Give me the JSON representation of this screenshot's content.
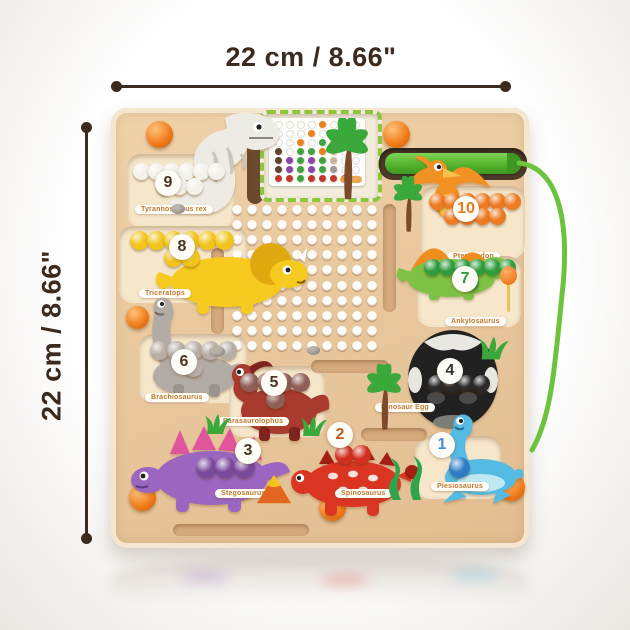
{
  "annotations": {
    "top_width_label": "22 cm / 8.66\"",
    "left_height_label": "22 cm / 8.66\"",
    "line_color": "#3b2a1d"
  },
  "board": {
    "wood_color": "#e9c89e",
    "pen_color": "#55b42d",
    "cord_color": "#6cc33e",
    "card_slot_color": "#8cc63e",
    "hole_grid": {
      "rows": 10,
      "cols": 10
    },
    "pattern_card": {
      "grid_rows": 7,
      "grid_cols": 8,
      "dots": [
        {
          "x": 4,
          "y": 0,
          "c": "#e8821e"
        },
        {
          "x": 3,
          "y": 1,
          "c": "#e8821e"
        },
        {
          "x": 5,
          "y": 1,
          "c": "#c9b79a"
        },
        {
          "x": 2,
          "y": 2,
          "c": "#e8821e"
        },
        {
          "x": 4,
          "y": 2,
          "c": "#3fa43f"
        },
        {
          "x": 5,
          "y": 2,
          "c": "#c9b79a"
        },
        {
          "x": 0,
          "y": 3,
          "c": "#5d4631"
        },
        {
          "x": 2,
          "y": 3,
          "c": "#3fa43f"
        },
        {
          "x": 3,
          "y": 3,
          "c": "#3fa43f"
        },
        {
          "x": 4,
          "y": 3,
          "c": "#e8821e"
        },
        {
          "x": 5,
          "y": 3,
          "c": "#c9b79a"
        },
        {
          "x": 0,
          "y": 4,
          "c": "#5d4631"
        },
        {
          "x": 1,
          "y": 4,
          "c": "#8e44ad"
        },
        {
          "x": 2,
          "y": 4,
          "c": "#3fa43f"
        },
        {
          "x": 3,
          "y": 4,
          "c": "#8e44ad"
        },
        {
          "x": 4,
          "y": 4,
          "c": "#3fa43f"
        },
        {
          "x": 5,
          "y": 4,
          "c": "#c9b79a"
        },
        {
          "x": 0,
          "y": 5,
          "c": "#5d4631"
        },
        {
          "x": 1,
          "y": 5,
          "c": "#8e44ad"
        },
        {
          "x": 2,
          "y": 5,
          "c": "#3fa43f"
        },
        {
          "x": 3,
          "y": 5,
          "c": "#8e44ad"
        },
        {
          "x": 4,
          "y": 5,
          "c": "#3fa43f"
        },
        {
          "x": 5,
          "y": 5,
          "c": "#9a9a9a"
        },
        {
          "x": 0,
          "y": 6,
          "c": "#c0392b"
        },
        {
          "x": 1,
          "y": 6,
          "c": "#c0392b"
        },
        {
          "x": 2,
          "y": 6,
          "c": "#3fa43f"
        },
        {
          "x": 3,
          "y": 6,
          "c": "#c0392b"
        },
        {
          "x": 4,
          "y": 6,
          "c": "#c0392b"
        },
        {
          "x": 5,
          "y": 6,
          "c": "#c0392b"
        },
        {
          "x": 6,
          "y": 6,
          "c": "#c0392b"
        }
      ]
    },
    "zones": [
      {
        "number": "9",
        "name": "Tyrannosaurus rex",
        "balls": 9,
        "ball_color": "#f3f1ea",
        "dino_color": "#edebe3",
        "accent_color": "#c9c6bd",
        "badge_color": "#4a3524"
      },
      {
        "number": "8",
        "name": "Triceratops",
        "balls": 8,
        "ball_color": "#f2c51d",
        "dino_color": "#f6ca1e",
        "accent_color": "#e0a90f",
        "badge_color": "#4a3524"
      },
      {
        "number": "10",
        "name": "Pteranodon",
        "balls": 10,
        "ball_color": "#ee7b22",
        "dino_color": "#f19124",
        "accent_color": "#f7c24a",
        "badge_color": "#ee7b22"
      },
      {
        "number": "7",
        "name": "Ankylosaurus",
        "balls": 7,
        "ball_color": "#2f9c3f",
        "dino_color": "#7dc244",
        "accent_color": "#ef8d1f",
        "badge_color": "#2f9c3f"
      },
      {
        "number": "6",
        "name": "Brachiosaurus",
        "balls": 6,
        "ball_color": "#b7aea6",
        "dino_color": "#b3aca6",
        "accent_color": "#9b938c",
        "badge_color": "#4a3524"
      },
      {
        "number": "5",
        "name": "Parasaurolophus",
        "balls": 5,
        "ball_color": "#8e5e57",
        "dino_color": "#a93a2e",
        "accent_color": "#7e241c",
        "badge_color": "#4a3524"
      },
      {
        "number": "4",
        "name": "Dinosaur Egg",
        "balls": 4,
        "ball_color": "#2a2a2a",
        "dino_color": "#212121",
        "accent_color": "#e9e7e2",
        "badge_color": "#333333"
      },
      {
        "number": "3",
        "name": "Stegosaurus",
        "balls": 3,
        "ball_color": "#7a4a9d",
        "dino_color": "#9a66c0",
        "accent_color": "#e0559c",
        "badge_color": "#4a3524"
      },
      {
        "number": "2",
        "name": "Spinosaurus",
        "balls": 2,
        "ball_color": "#d2301f",
        "dino_color": "#da3522",
        "accent_color": "#a31f12",
        "badge_color": "#c05a1e"
      },
      {
        "number": "1",
        "name": "Plesiosaurus",
        "balls": 1,
        "ball_color": "#2e7cc5",
        "dino_color": "#56bbe3",
        "accent_color": "#bfe8f2",
        "badge_color": "#3e8fd5"
      }
    ]
  }
}
